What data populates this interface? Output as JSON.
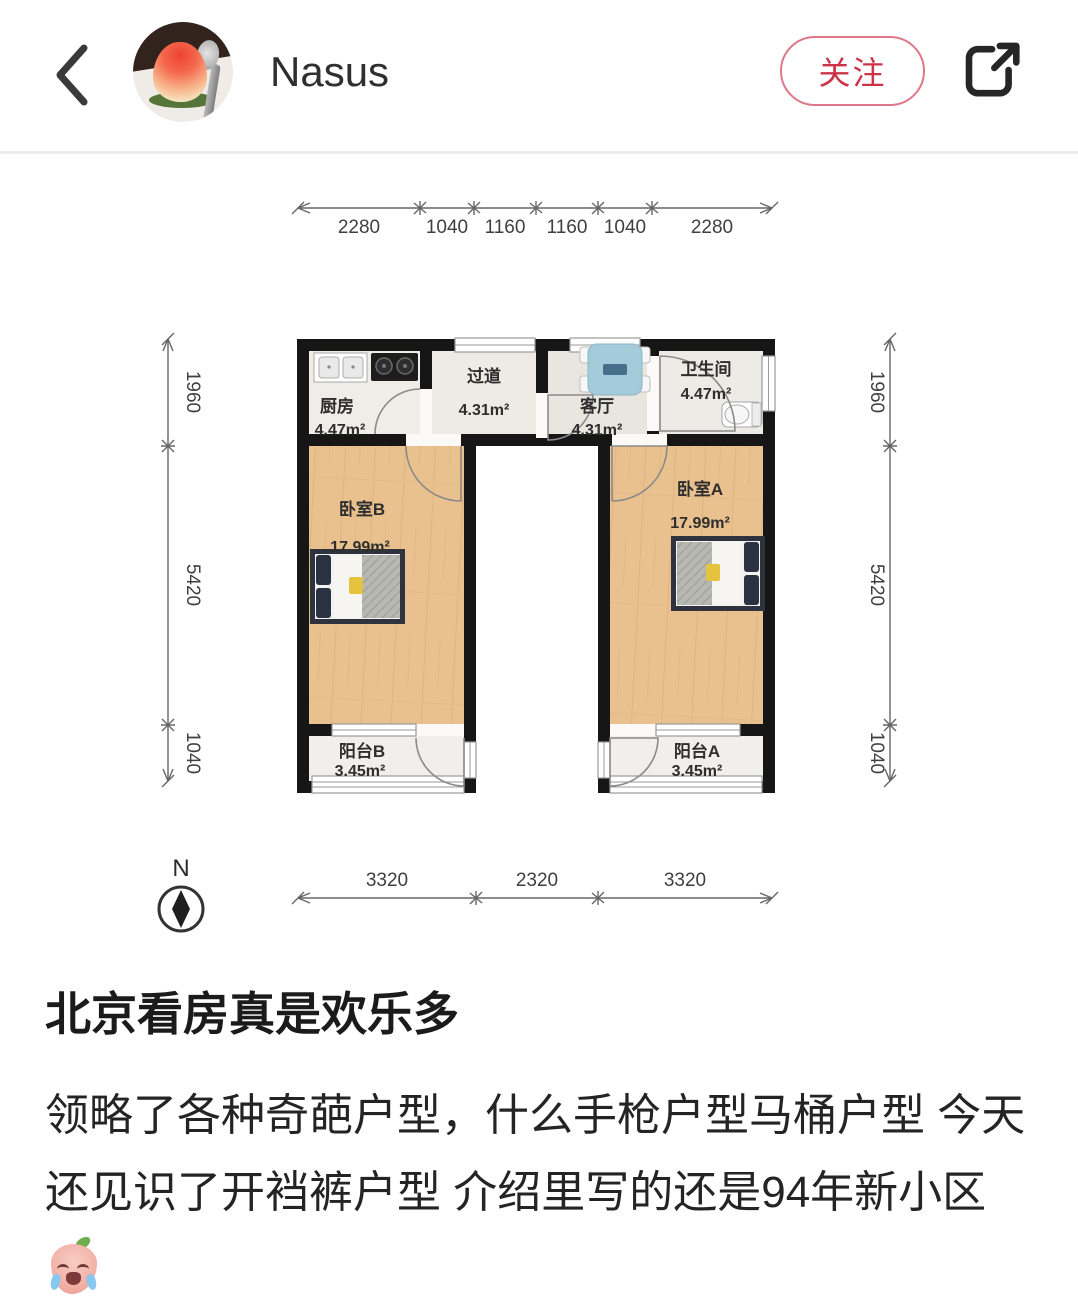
{
  "header": {
    "username": "Nasus",
    "follow_label": "关注"
  },
  "post": {
    "title": "北京看房真是欢乐多",
    "body": "领略了各种奇葩户型，什么手枪户型马桶户型 今天还见识了开裆裤户型 介绍里写的还是94年新小区",
    "emoji": "crying-emoji"
  },
  "floorplan": {
    "compass_label": "N",
    "dims_top": [
      "2280",
      "1040",
      "1160",
      "1160",
      "1040",
      "2280"
    ],
    "dims_left": [
      "1960",
      "5420",
      "1040"
    ],
    "dims_right": [
      "1960",
      "5420",
      "1040"
    ],
    "dims_bottom": [
      "3320",
      "2320",
      "3320"
    ],
    "rooms": {
      "kitchen": {
        "name": "厨房",
        "area": "4.47m²"
      },
      "hallway": {
        "name": "过道",
        "area": "4.31m²"
      },
      "living": {
        "name": "客厅",
        "area": "4.31m²"
      },
      "bathroom": {
        "name": "卫生间",
        "area": "4.47m²"
      },
      "bedroomB": {
        "name": "卧室B",
        "area": "17.99m²"
      },
      "bedroomA": {
        "name": "卧室A",
        "area": "17.99m²"
      },
      "balconyB": {
        "name": "阳台B",
        "area": "3.45m²"
      },
      "balconyA": {
        "name": "阳台A",
        "area": "3.45m²"
      }
    }
  }
}
